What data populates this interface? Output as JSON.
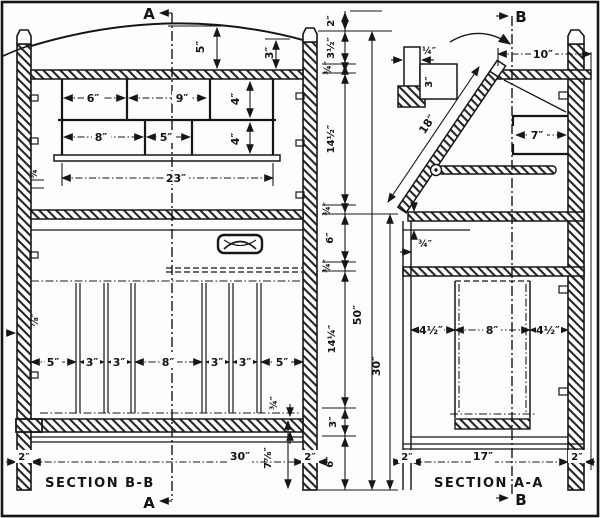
{
  "drawing": {
    "markers": {
      "a": "A",
      "b": "B"
    },
    "section_bb": {
      "title": "SECTION B-B",
      "arch_height": "5″",
      "arch_side": "3″",
      "ph_row1_w1": "6″",
      "ph_row1_w2": "9″",
      "ph_row1_h": "4″",
      "ph_row2_w1": "8″",
      "ph_row2_w2": "5″",
      "ph_row2_h": "4″",
      "ph_total_width": "23″",
      "slat_widths": [
        "5″",
        "3″",
        "3″",
        "8″",
        "3″",
        "3″",
        "5″"
      ],
      "top_rail_thickness": "¾″",
      "side_thickness": "⅞″",
      "slat_rail_thickness": "¾″",
      "base_height": "7⅞″",
      "left_leg_width": "2″",
      "overall_width": "30″",
      "right_post_width": "2″"
    },
    "section_aa": {
      "title": "SECTION A-A",
      "top_depth": "10″",
      "lip_width": "¼″",
      "lip_height": "3″",
      "fall_front_length": "18″",
      "pigeonhole_depth": "7″",
      "bed_thickness": "¾″",
      "bottom_front_width": "4½″",
      "bottom_middle_width": "8″",
      "bottom_back_width": "4½″",
      "front_leg_width": "2″",
      "interior_depth": "17″",
      "back_post_width": "2″"
    },
    "height_chain": {
      "seg1": "2″",
      "seg2": "3½″",
      "seg3": "¾″",
      "seg4": "14½″",
      "seg5": "¾″",
      "seg6": "6″",
      "seg7": "¾″",
      "seg8": "14¼″",
      "seg9": "3″",
      "seg10": "6″",
      "overall_height": "50″",
      "lower_height": "30″"
    }
  }
}
